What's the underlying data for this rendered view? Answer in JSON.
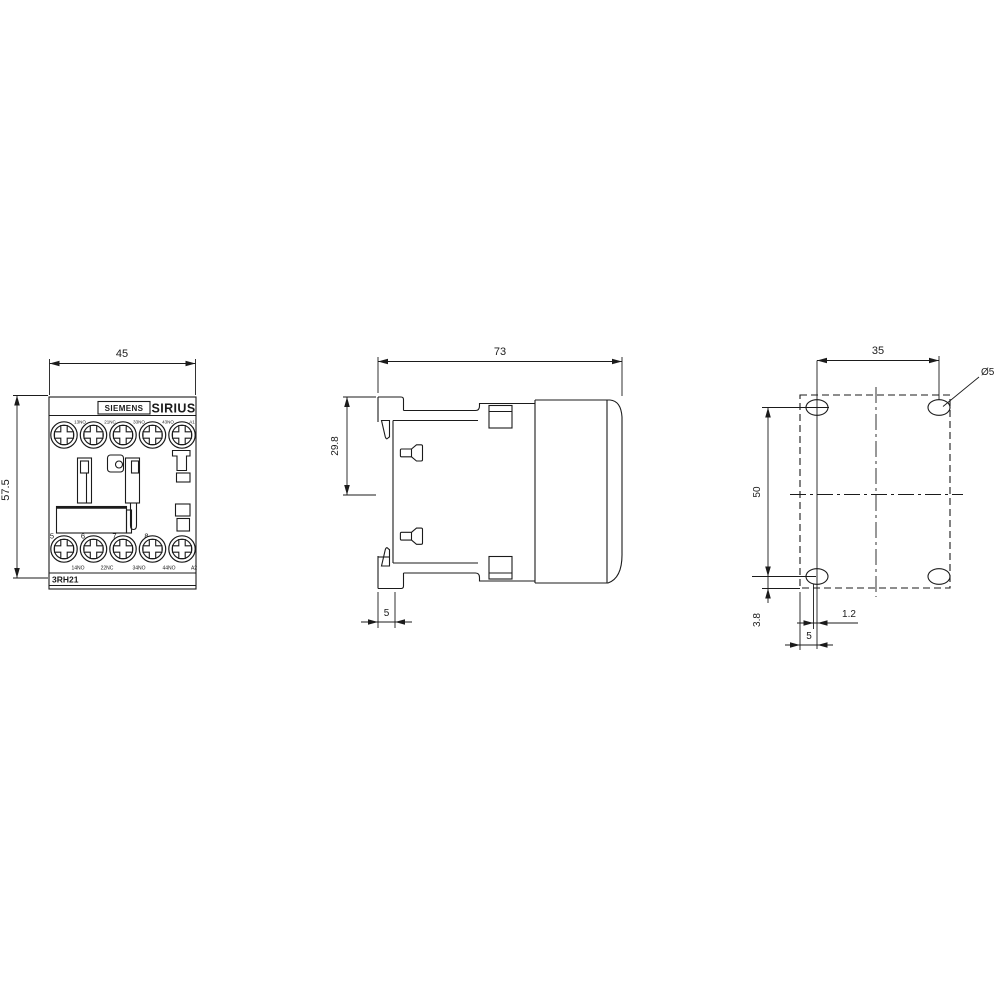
{
  "drawing": {
    "front_view": {
      "brand_label": "SIEMENS",
      "series_label": "SIRIUS",
      "model_label": "3RH21",
      "dim_width": "45",
      "dim_height": "57.5",
      "top_terminal_labels": [
        "13NO",
        "21NC",
        "33NO",
        "43NO",
        "A1"
      ],
      "bottom_terminal_numbers": [
        "5",
        "6",
        "7",
        "8"
      ],
      "bottom_terminal_labels": [
        "14NO",
        "22NC",
        "34NO",
        "44NO",
        "A2"
      ]
    },
    "side_view": {
      "dim_depth": "73",
      "dim_rail_offset": "29.8",
      "dim_foot": "5"
    },
    "mounting_view": {
      "dim_hole_spacing_horizontal": "35",
      "hole_diameter_label": "Ø5",
      "dim_hole_spacing_vertical": "50",
      "dim_edge_offset": "3.8",
      "dim_slot": "1.2",
      "dim_hole_edge": "5"
    }
  }
}
